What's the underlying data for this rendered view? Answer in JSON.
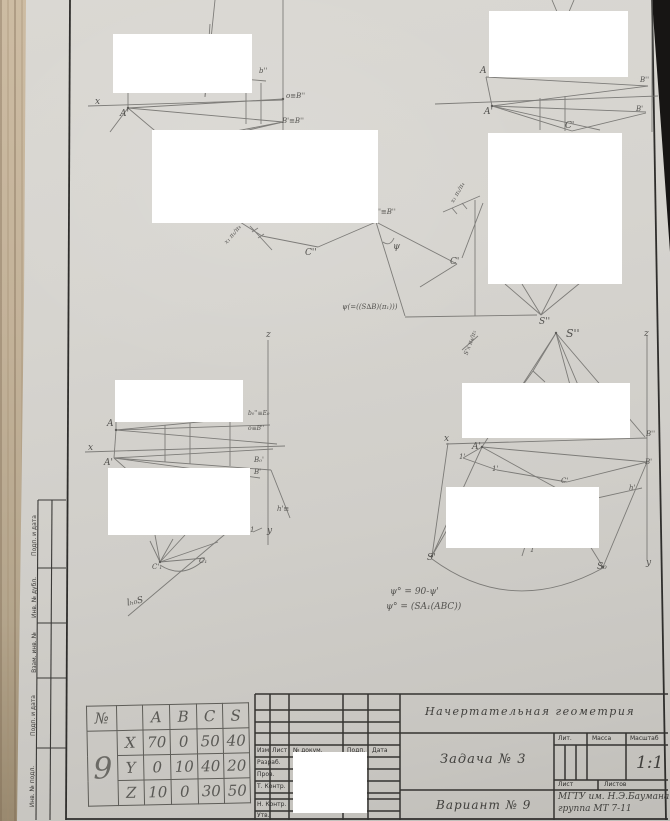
{
  "stamp_column": {
    "labels": [
      "Подп. и дата",
      "Инв. № дубл.",
      "Взам. инв. №",
      "Подп. и дата",
      "Инв. № подл."
    ]
  },
  "coordinate_table": {
    "number_header": "№",
    "variant_number": "9",
    "point_headers": [
      "A",
      "B",
      "C",
      "S"
    ],
    "rows": [
      {
        "axis": "X",
        "values": [
          "70",
          "0",
          "50",
          "40"
        ]
      },
      {
        "axis": "Y",
        "values": [
          "0",
          "10",
          "40",
          "20"
        ]
      },
      {
        "axis": "Z",
        "values": [
          "10",
          "0",
          "30",
          "50"
        ]
      }
    ]
  },
  "title_block": {
    "subject": "Начертательная геометрия",
    "task": "Задача № 3",
    "variant": "Вариант № 9",
    "org_line1": "МГТУ им. Н.Э.Баумана",
    "org_line2": "группа МТ 7-11",
    "scale": "1:1",
    "lit": "Лит.",
    "massa": "Масса",
    "masshtab": "Масштаб",
    "list": "Лист",
    "listov": "Листов",
    "izm": "Изм.",
    "list2": "Лист",
    "dokum": "№ докум.",
    "podp": "Подп.",
    "data_col": "Дата",
    "razrab": "Разраб.",
    "prov": "Пров.",
    "tkontr": "Т. Контр.",
    "nkontr": "Н. Контр.",
    "utv": "Утв."
  },
  "labels": [
    "x",
    "A'",
    "b''",
    "o≡B''",
    "B'≡B''",
    "x₁ π₁/π₄",
    "C''",
    "A''≡B''",
    "ψ",
    "ψ(=((S∆B)(π₁)))",
    "S''",
    "A",
    "A'",
    "B''",
    "B'",
    "C'",
    "x₁ π₁/π₄",
    "C'",
    "S''",
    "z",
    "S'x π₄/π₅",
    "z",
    "A",
    "x",
    "A'",
    "b₀''≡E₀",
    "o≡B''",
    "B₀'",
    "B'",
    "h'≡",
    "1",
    "y",
    "C'₁",
    "C₁",
    "lₕ₀S",
    "x",
    "A'",
    "1'",
    "1'",
    "C'",
    "h'",
    "B''",
    "B'",
    "S'",
    "1",
    "S₀",
    "y",
    "ψ° = 90-ψ'",
    "ψ° = (SA₁(ABC))"
  ]
}
